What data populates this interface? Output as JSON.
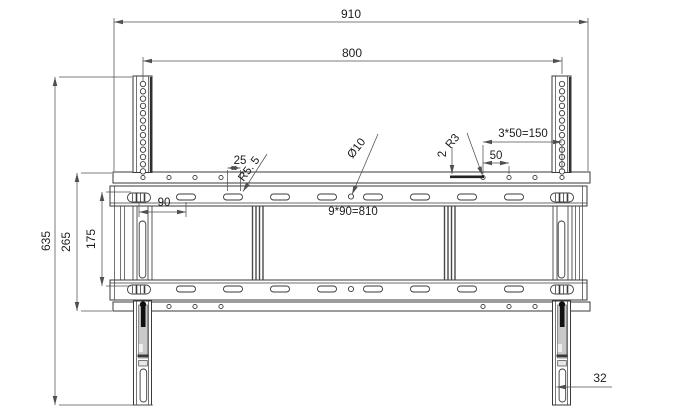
{
  "drawing": {
    "background": "#ffffff",
    "line_color": "#3a3a3a",
    "dim_color": "#4f4f4f",
    "pin_color": "#101010",
    "dimensions": {
      "overall_width": "910",
      "mount_hole_span": "800",
      "overall_height": "635",
      "plate_height": "265",
      "rail_pitch": "175",
      "slot_pitch": "90",
      "slot_length": "25",
      "slot_end_radius": "R5. 5",
      "center_hole_diameter": "Ø10",
      "hook_radius": "R3",
      "plate_thickness": "2",
      "top_hole_pitch": "50",
      "top_hole_span": "3*50=150",
      "slot_pitch_total": "9*90=810",
      "strut_width": "32"
    }
  }
}
